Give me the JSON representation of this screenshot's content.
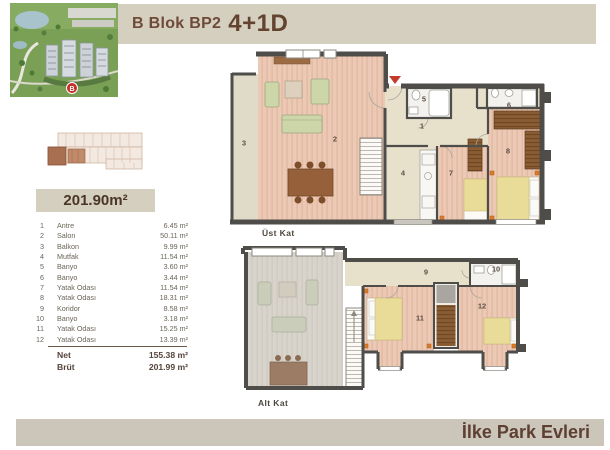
{
  "header": {
    "title_prefix": "B Blok BP2",
    "title_suffix": "4+1D"
  },
  "area_box": {
    "value": "201.90m²"
  },
  "rooms": {
    "rows": [
      {
        "no": "1",
        "name": "Antre",
        "area": "6.45 m²"
      },
      {
        "no": "2",
        "name": "Salon",
        "area": "50.11 m²"
      },
      {
        "no": "3",
        "name": "Balkon",
        "area": "9.99 m²"
      },
      {
        "no": "4",
        "name": "Mutfak",
        "area": "11.54 m²"
      },
      {
        "no": "5",
        "name": "Banyo",
        "area": "3.60 m²"
      },
      {
        "no": "6",
        "name": "Banyo",
        "area": "3.44 m²"
      },
      {
        "no": "7",
        "name": "Yatak Odası",
        "area": "11.54 m²"
      },
      {
        "no": "8",
        "name": "Yatak Odası",
        "area": "18.31 m²"
      },
      {
        "no": "9",
        "name": "Koridor",
        "area": "8.58 m²"
      },
      {
        "no": "10",
        "name": "Banyo",
        "area": "3.18 m²"
      },
      {
        "no": "11",
        "name": "Yatak Odası",
        "area": "15.25 m²"
      },
      {
        "no": "12",
        "name": "Yatak Odası",
        "area": "13.39 m²"
      }
    ],
    "totals": [
      {
        "label": "Net",
        "value": "155.38 m²"
      },
      {
        "label": "Brüt",
        "value": "201.99 m²"
      }
    ]
  },
  "plans": {
    "upper": {
      "label": "Üst Kat",
      "labels": [
        {
          "t": "3",
          "x": 16,
          "y": 97
        },
        {
          "t": "2",
          "x": 107,
          "y": 93
        },
        {
          "t": "1",
          "x": 194,
          "y": 80
        },
        {
          "t": "5",
          "x": 196,
          "y": 53
        },
        {
          "t": "6",
          "x": 281,
          "y": 59
        },
        {
          "t": "4",
          "x": 175,
          "y": 127
        },
        {
          "t": "7",
          "x": 223,
          "y": 127
        },
        {
          "t": "8",
          "x": 280,
          "y": 105
        }
      ]
    },
    "lower": {
      "label": "Alt Kat",
      "labels": [
        {
          "t": "9",
          "x": 198,
          "y": 26
        },
        {
          "t": "10",
          "x": 268,
          "y": 23
        },
        {
          "t": "11",
          "x": 192,
          "y": 72
        },
        {
          "t": "12",
          "x": 254,
          "y": 60
        }
      ]
    }
  },
  "photo": {
    "marker": "B"
  },
  "footer": {
    "brand": "İlke Park Evleri"
  },
  "colors": {
    "banner_bg": "#d5cfc0",
    "title_brown": "#6e4a38",
    "footer_bg": "#cbc6b9",
    "wall": "#4f4d4a",
    "wood_floor": "#ecc9b4",
    "hall_floor": "#e7e1cc",
    "bath_floor": "#f3f2ef",
    "ghost_floor": "#d8d4cb",
    "bed_blanket": "#e9dc98",
    "wardrobe_brown": "#8a5c33",
    "accent_orange": "#d97b2a",
    "entrance_red": "#c23b2e"
  }
}
